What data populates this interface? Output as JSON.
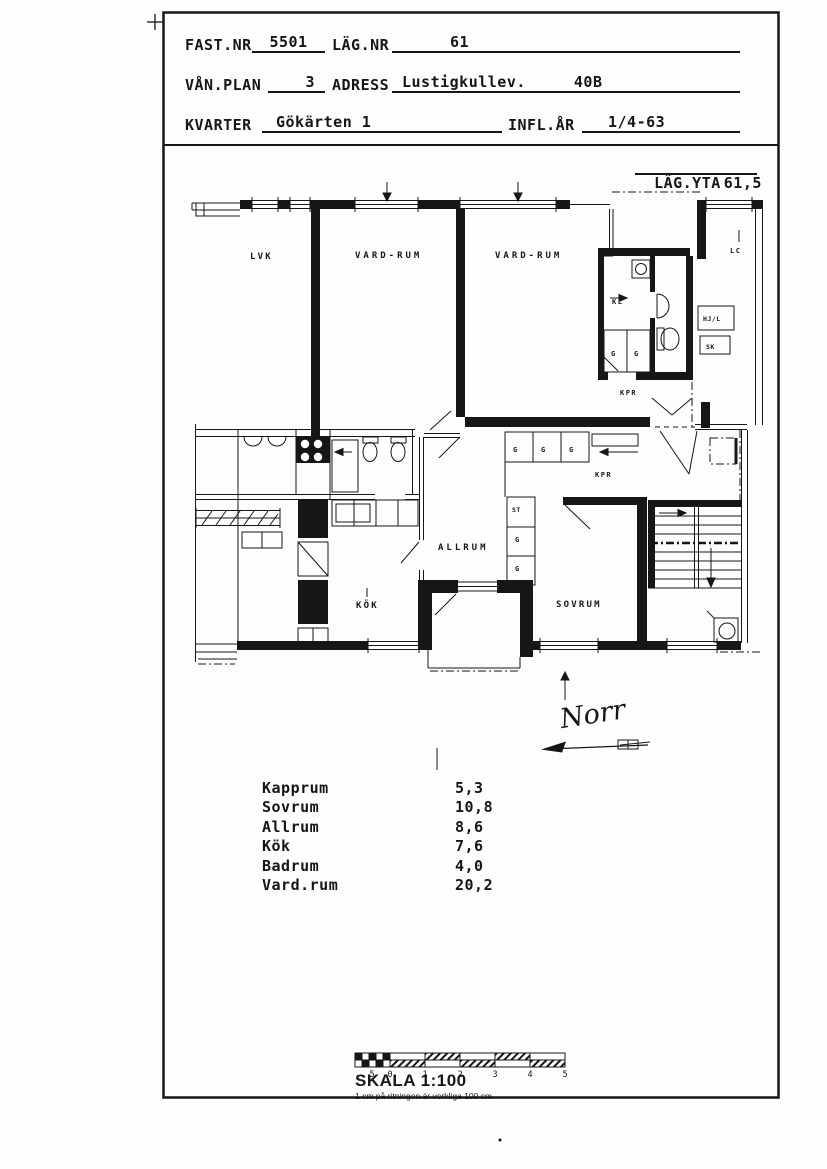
{
  "header": {
    "fast_nr_label": "FAST.NR",
    "fast_nr": "5501",
    "lag_nr_label": "LÄG.NR",
    "lag_nr": "61",
    "van_plan_label": "VÅN.PLAN",
    "van_plan": "3",
    "adress_label": "ADRESS",
    "adress": "Lustigkullev.",
    "adress_nr": "40B",
    "kvarter_label": "KVARTER",
    "kvarter": "Gökärten 1",
    "infl_ar_label": "INFL.ÅR",
    "infl_ar": "1/4-63"
  },
  "area": {
    "label": "LÄG.YTA",
    "value": "61,5"
  },
  "plan": {
    "rooms": {
      "neighbor": "LVK",
      "vardrum_left": "VARD-RUM",
      "vardrum_right": "VARD-RUM",
      "allrum": "ALLRUM",
      "kok": "KÖK",
      "sovrum": "SOVRUM"
    },
    "small": {
      "kl": "KL",
      "g": "G",
      "st": "ST",
      "kpr": "KPR",
      "lc": "LC",
      "hjl": "HJ/L",
      "sk": "SK"
    },
    "north": "Norr"
  },
  "room_list": [
    {
      "name": "Kapprum",
      "area": "5,3"
    },
    {
      "name": "Sovrum",
      "area": "10,8"
    },
    {
      "name": "Allrum",
      "area": "8,6"
    },
    {
      "name": "Kök",
      "area": "7,6"
    },
    {
      "name": "Badrum",
      "area": "4,0"
    },
    {
      "name": "Vard.rum",
      "area": "20,2"
    }
  ],
  "scale": {
    "title": "SKALA 1:100",
    "note": "1 cm på ritningen är verkliga 100 cm",
    "ticks": [
      "5",
      "0",
      "1",
      "2",
      "3",
      "4",
      "5"
    ]
  }
}
